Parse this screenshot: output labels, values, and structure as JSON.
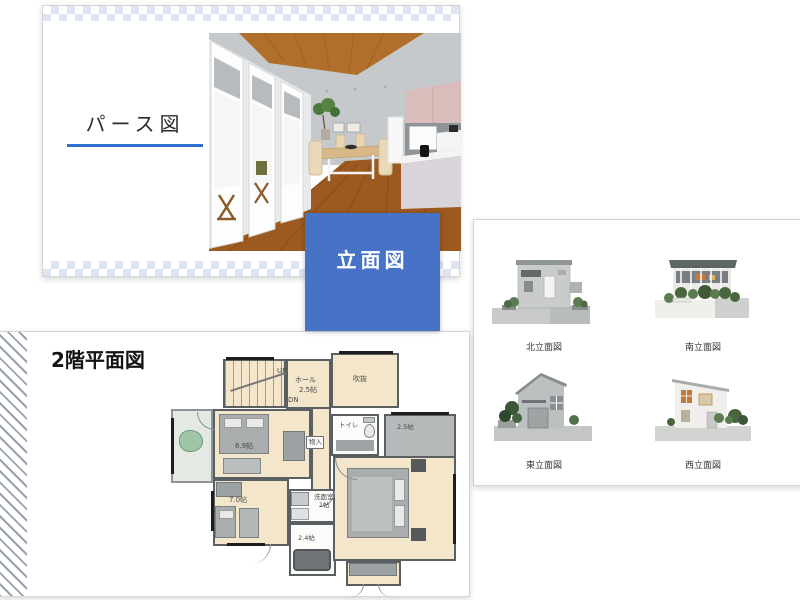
{
  "perspective_card": {
    "title": "パース図",
    "underline_color": "#2f6fd0"
  },
  "elevation_label_box": {
    "label": "立面図",
    "bg_color": "#4673c5"
  },
  "elevations_card": {
    "north_label": "北立面図",
    "south_label": "南立面図",
    "east_label": "東立面図",
    "west_label": "西立面図"
  },
  "floorplan": {
    "title": "2階平面図",
    "labels": {
      "up": "UP",
      "down": "DN",
      "hall": "ホール",
      "hall_size": "2.5帖",
      "void": "吹抜",
      "bedroom_size": "6.9帖",
      "storage": "物入",
      "toilet": "トイレ",
      "closet_size": "2.5帖",
      "kids_size": "7.0帖",
      "washroom": "洗面室",
      "washroom_size": "1帖",
      "bath_size": "2.4帖"
    }
  }
}
